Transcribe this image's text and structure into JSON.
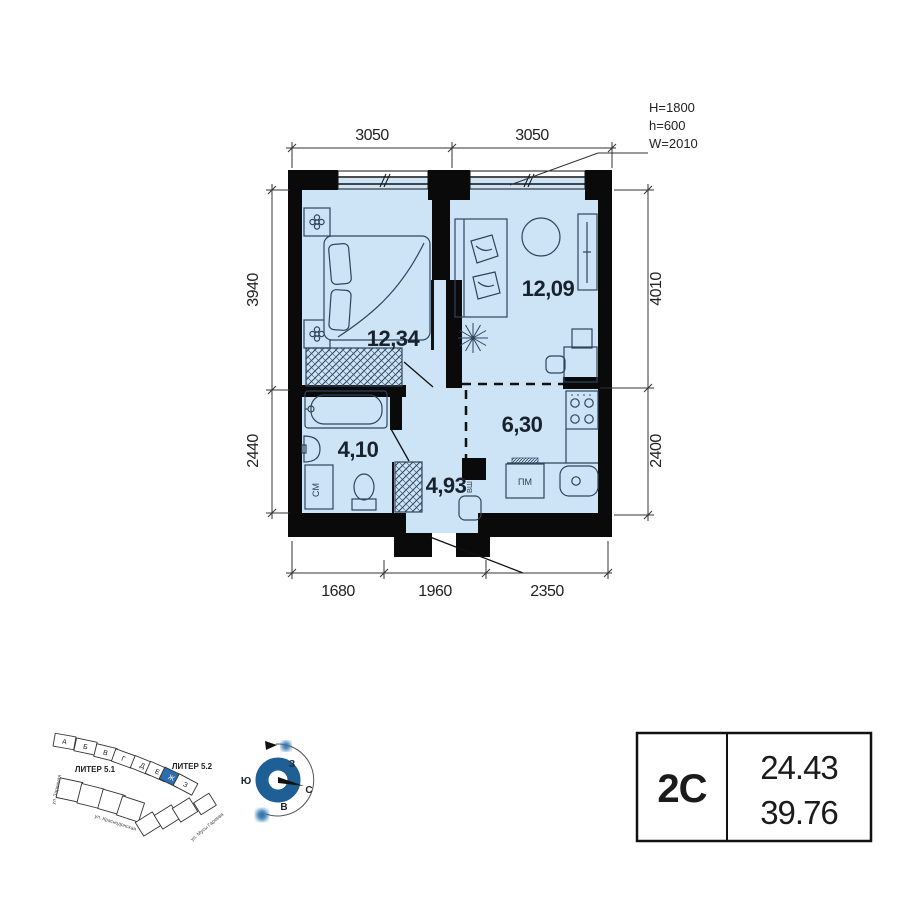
{
  "plan": {
    "dims_top": [
      "3050",
      "3050"
    ],
    "dims_left": [
      "3940",
      "2440"
    ],
    "dims_right": [
      "4010",
      "2400"
    ],
    "dims_bottom": [
      "1680",
      "1960",
      "2350"
    ],
    "window_spec": [
      "H=1800",
      "h=600",
      "W=2010"
    ],
    "areas": {
      "bedroom": "12,34",
      "living": "12,09",
      "kitchen": "6,30",
      "bathroom": "4,10",
      "hall": "4,93"
    },
    "equipment": {
      "washer": "СМ",
      "dishwasher": "ПМ",
      "hall_wardrobe": "ВШ"
    }
  },
  "site": {
    "liter_1": "ЛИТЕР 5.1",
    "liter_2": "ЛИТЕР 5.2",
    "sections": [
      "А",
      "Б",
      "В",
      "Г",
      "Д",
      "Е",
      "Ж",
      "З"
    ],
    "highlighted_section": "Ж",
    "streets": {
      "left": "ул. Заречная",
      "bottom": "ул. Краснодонская",
      "right": "ул. Мусы Гареева"
    }
  },
  "compass": {
    "north": "С",
    "south": "Ю",
    "west": "З",
    "east": "В"
  },
  "summary": {
    "plan_type": "2С",
    "area_living": "24.43",
    "area_total": "39.76"
  },
  "colors": {
    "room_fill": "#cde4f6",
    "wall": "#0a0a0a",
    "accent_blue": "#1e5f95",
    "sun_blue": "#2e76ad",
    "furniture_stroke": "#30445c"
  }
}
